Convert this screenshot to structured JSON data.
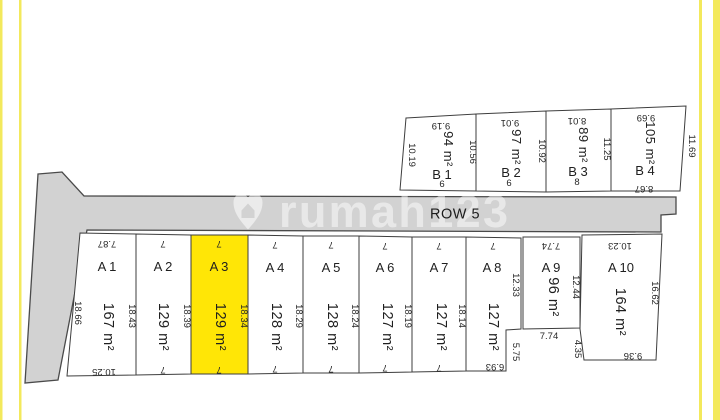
{
  "frame": {
    "border_color": "#f3e95c"
  },
  "road": {
    "label": "ROW 5",
    "fill": "#d2d2d2",
    "polygon": "38,174 62,172 84,196 676,197 676,214 661,215 661,232 87,230 58,380 25,383"
  },
  "watermark": {
    "text": "rumah123",
    "logo": "rumah123-heart-shield-logo"
  },
  "highlight_color": "#ffe606",
  "plots": [
    {
      "id": "A1",
      "name": "A 1",
      "area": "167 m²",
      "highlighted": false,
      "area_size": 14.5,
      "poly": "80,233 136,234 136,375 67,376",
      "name_xy": [
        107,
        271
      ],
      "area_xy": [
        104,
        327
      ],
      "dims": [
        {
          "t": "7.87",
          "x": 107,
          "y": 241,
          "r": 180
        },
        {
          "t": "18.66",
          "x": 75,
          "y": 313,
          "r": 90
        },
        {
          "t": "18.43",
          "x": 129,
          "y": 316,
          "r": 90
        },
        {
          "t": "10.25",
          "x": 104,
          "y": 369,
          "r": 180
        }
      ]
    },
    {
      "id": "A2",
      "name": "A 2",
      "area": "129 m²",
      "highlighted": false,
      "area_size": 14.5,
      "poly": "136,234 191,235 191,374 136,375",
      "name_xy": [
        163,
        271
      ],
      "area_xy": [
        159,
        327
      ],
      "dims": [
        {
          "t": "7",
          "x": 163,
          "y": 241,
          "r": 180
        },
        {
          "t": "18.39",
          "x": 184,
          "y": 316,
          "r": 90
        },
        {
          "t": "7",
          "x": 163,
          "y": 367,
          "r": 180
        }
      ]
    },
    {
      "id": "A3",
      "name": "A 3",
      "area": "129 m²",
      "highlighted": true,
      "area_size": 14.5,
      "poly": "191,235 248,235 248,374 191,374",
      "name_xy": [
        219,
        271
      ],
      "area_xy": [
        216,
        327
      ],
      "dims": [
        {
          "t": "7",
          "x": 219,
          "y": 241,
          "r": 180
        },
        {
          "t": "18.34",
          "x": 241,
          "y": 316,
          "r": 90
        },
        {
          "t": "7",
          "x": 219,
          "y": 367,
          "r": 180
        }
      ]
    },
    {
      "id": "A4",
      "name": "A 4",
      "area": "128 m²",
      "highlighted": false,
      "area_size": 14.5,
      "poly": "248,235 303,236 303,373 248,374",
      "name_xy": [
        275,
        272
      ],
      "area_xy": [
        272,
        327
      ],
      "dims": [
        {
          "t": "7",
          "x": 275,
          "y": 242,
          "r": 180
        },
        {
          "t": "18.29",
          "x": 296,
          "y": 316,
          "r": 90
        },
        {
          "t": "7",
          "x": 275,
          "y": 366,
          "r": 180
        }
      ]
    },
    {
      "id": "A5",
      "name": "A 5",
      "area": "128 m²",
      "highlighted": false,
      "area_size": 14.5,
      "poly": "303,236 359,236 359,373 303,373",
      "name_xy": [
        331,
        272
      ],
      "area_xy": [
        328,
        327
      ],
      "dims": [
        {
          "t": "7",
          "x": 331,
          "y": 242,
          "r": 180
        },
        {
          "t": "18.24",
          "x": 352,
          "y": 316,
          "r": 90
        },
        {
          "t": "7",
          "x": 331,
          "y": 366,
          "r": 180
        }
      ]
    },
    {
      "id": "A6",
      "name": "A 6",
      "area": "127 m²",
      "highlighted": false,
      "area_size": 14.5,
      "poly": "359,236 412,237 412,372 359,373",
      "name_xy": [
        385,
        272
      ],
      "area_xy": [
        383,
        327
      ],
      "dims": [
        {
          "t": "7",
          "x": 385,
          "y": 243,
          "r": 180
        },
        {
          "t": "18.19",
          "x": 405,
          "y": 316,
          "r": 90
        },
        {
          "t": "7",
          "x": 385,
          "y": 365,
          "r": 180
        }
      ]
    },
    {
      "id": "A7",
      "name": "A 7",
      "area": "127 m²",
      "highlighted": false,
      "area_size": 14.5,
      "poly": "412,237 466,237 466,371 412,372",
      "name_xy": [
        439,
        272
      ],
      "area_xy": [
        437,
        327
      ],
      "dims": [
        {
          "t": "7",
          "x": 439,
          "y": 243,
          "r": 180
        },
        {
          "t": "18.14",
          "x": 459,
          "y": 316,
          "r": 90
        },
        {
          "t": "7",
          "x": 439,
          "y": 365,
          "r": 180
        }
      ]
    },
    {
      "id": "A8",
      "name": "A 8",
      "area": "127 m²",
      "highlighted": false,
      "area_size": 14.5,
      "poly": "466,237 521,238 521,329 506,330 506,371 466,371",
      "name_xy": [
        492,
        272
      ],
      "area_xy": [
        489,
        327
      ],
      "dims": [
        {
          "t": "7",
          "x": 493,
          "y": 243,
          "r": 180
        },
        {
          "t": "12.33",
          "x": 513,
          "y": 285,
          "r": 90
        },
        {
          "t": "5.75",
          "x": 513,
          "y": 352,
          "r": 90
        },
        {
          "t": "6.93",
          "x": 495,
          "y": 364,
          "r": 180
        }
      ]
    },
    {
      "id": "A9",
      "name": "A 9",
      "area": "96 m²",
      "highlighted": false,
      "area_size": 14.5,
      "poly": "523,237 580,237 580,328 523,329",
      "name_xy": [
        551,
        272
      ],
      "area_xy": [
        549,
        297
      ],
      "dims": [
        {
          "t": "7.74",
          "x": 551,
          "y": 243,
          "r": 180
        },
        {
          "t": "12.44",
          "x": 573,
          "y": 287,
          "r": 90
        },
        {
          "t": "7.74",
          "x": 549,
          "y": 339,
          "r": 0
        }
      ]
    },
    {
      "id": "A10",
      "name": "A 10",
      "area": "164 m²",
      "highlighted": false,
      "area_size": 14.5,
      "poly": "582,235 662,234 656,360 584,360 580,329",
      "name_xy": [
        621,
        272
      ],
      "area_xy": [
        616,
        312
      ],
      "dims": [
        {
          "t": "10.23",
          "x": 620,
          "y": 243,
          "r": 180
        },
        {
          "t": "16.62",
          "x": 652,
          "y": 293,
          "r": 90
        },
        {
          "t": "4.35",
          "x": 575,
          "y": 349,
          "r": 90
        },
        {
          "t": "9.36",
          "x": 633,
          "y": 353,
          "r": 180
        }
      ]
    },
    {
      "id": "B1",
      "name": "B 1",
      "area": "94 m²",
      "highlighted": false,
      "area_size": 13,
      "poly": "406,118 476,114 476,191 400,190",
      "name_xy": [
        442,
        179
      ],
      "area_xy": [
        444,
        149
      ],
      "dims": [
        {
          "t": "9.19",
          "x": 441,
          "y": 123,
          "r": 180
        },
        {
          "t": "10.19",
          "x": 409,
          "y": 155,
          "r": 90
        },
        {
          "t": "10.56",
          "x": 470,
          "y": 152,
          "r": 90
        },
        {
          "t": "6",
          "x": 442,
          "y": 187,
          "r": 0
        }
      ]
    },
    {
      "id": "B2",
      "name": "B 2",
      "area": "97 m²",
      "highlighted": false,
      "area_size": 13,
      "poly": "476,114 546,111 546,192 476,191",
      "name_xy": [
        511,
        177
      ],
      "area_xy": [
        512,
        147
      ],
      "dims": [
        {
          "t": "9.01",
          "x": 510,
          "y": 120,
          "r": 180
        },
        {
          "t": "10.92",
          "x": 539,
          "y": 151,
          "r": 90
        },
        {
          "t": "6",
          "x": 509,
          "y": 186,
          "r": 0
        }
      ]
    },
    {
      "id": "B3",
      "name": "B 3",
      "area": "89 m²",
      "highlighted": false,
      "area_size": 13,
      "poly": "546,111 611,109 611,191 546,192",
      "name_xy": [
        578,
        176
      ],
      "area_xy": [
        579,
        145
      ],
      "dims": [
        {
          "t": "8.01",
          "x": 577,
          "y": 118,
          "r": 180
        },
        {
          "t": "11.25",
          "x": 604,
          "y": 149,
          "r": 90
        },
        {
          "t": "8",
          "x": 577,
          "y": 185,
          "r": 0
        }
      ]
    },
    {
      "id": "B4",
      "name": "B 4",
      "area": "105 m²",
      "highlighted": false,
      "area_size": 13,
      "poly": "611,109 686,106 680,191 611,191",
      "name_xy": [
        645,
        175
      ],
      "area_xy": [
        646,
        143
      ],
      "dims": [
        {
          "t": "9.69",
          "x": 646,
          "y": 115,
          "r": 180
        },
        {
          "t": "11.69",
          "x": 689,
          "y": 146,
          "r": 90
        },
        {
          "t": "8.67",
          "x": 644,
          "y": 186,
          "r": 180
        }
      ]
    }
  ]
}
